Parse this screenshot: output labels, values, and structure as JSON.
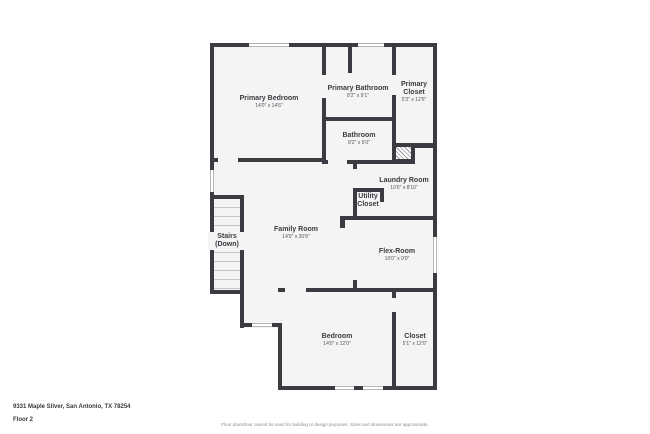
{
  "floor_plan": {
    "rooms": [
      {
        "name": "Primary Bedroom",
        "dims": "14'0\" x 14'6\""
      },
      {
        "name": "Primary Bathroom",
        "dims": "8'2\" x 9'1\""
      },
      {
        "name": "Primary Closet",
        "dims": "5'3\" x 12'6\""
      },
      {
        "name": "Bathroom",
        "dims": "8'2\" x 5'0\""
      },
      {
        "name": "Laundry Room",
        "dims": "10'0\" x 8'10\""
      },
      {
        "name": "Utility Closet"
      },
      {
        "name": "Family Room",
        "dims": "14'0\" x 20'8\""
      },
      {
        "name": "Stairs (Down)"
      },
      {
        "name": "Flex-Room",
        "dims": "10'0\" x 9'0\""
      },
      {
        "name": "Bedroom",
        "dims": "14'0\" x 12'0\""
      },
      {
        "name": "Closet",
        "dims": "5'1\" x 12'0\""
      }
    ],
    "features": [
      "window",
      "door-opening",
      "hatched-chase-area",
      "stair-treads"
    ]
  },
  "footer": {
    "address": "9331 Maple Silver, San Antonio, TX 78254",
    "floor_label": "Floor 2",
    "disclaimer": "Floor plans/tour cannot be used for building or design purposes. Sizes and dimensions are approximate."
  },
  "colors": {
    "wall": "#3b3b42",
    "floor": "#f4f4f4",
    "background": "#ffffff",
    "window_frame": "#b5b5b5",
    "text": "#3a3a42",
    "disclaimer_text": "#8b8b8b"
  }
}
